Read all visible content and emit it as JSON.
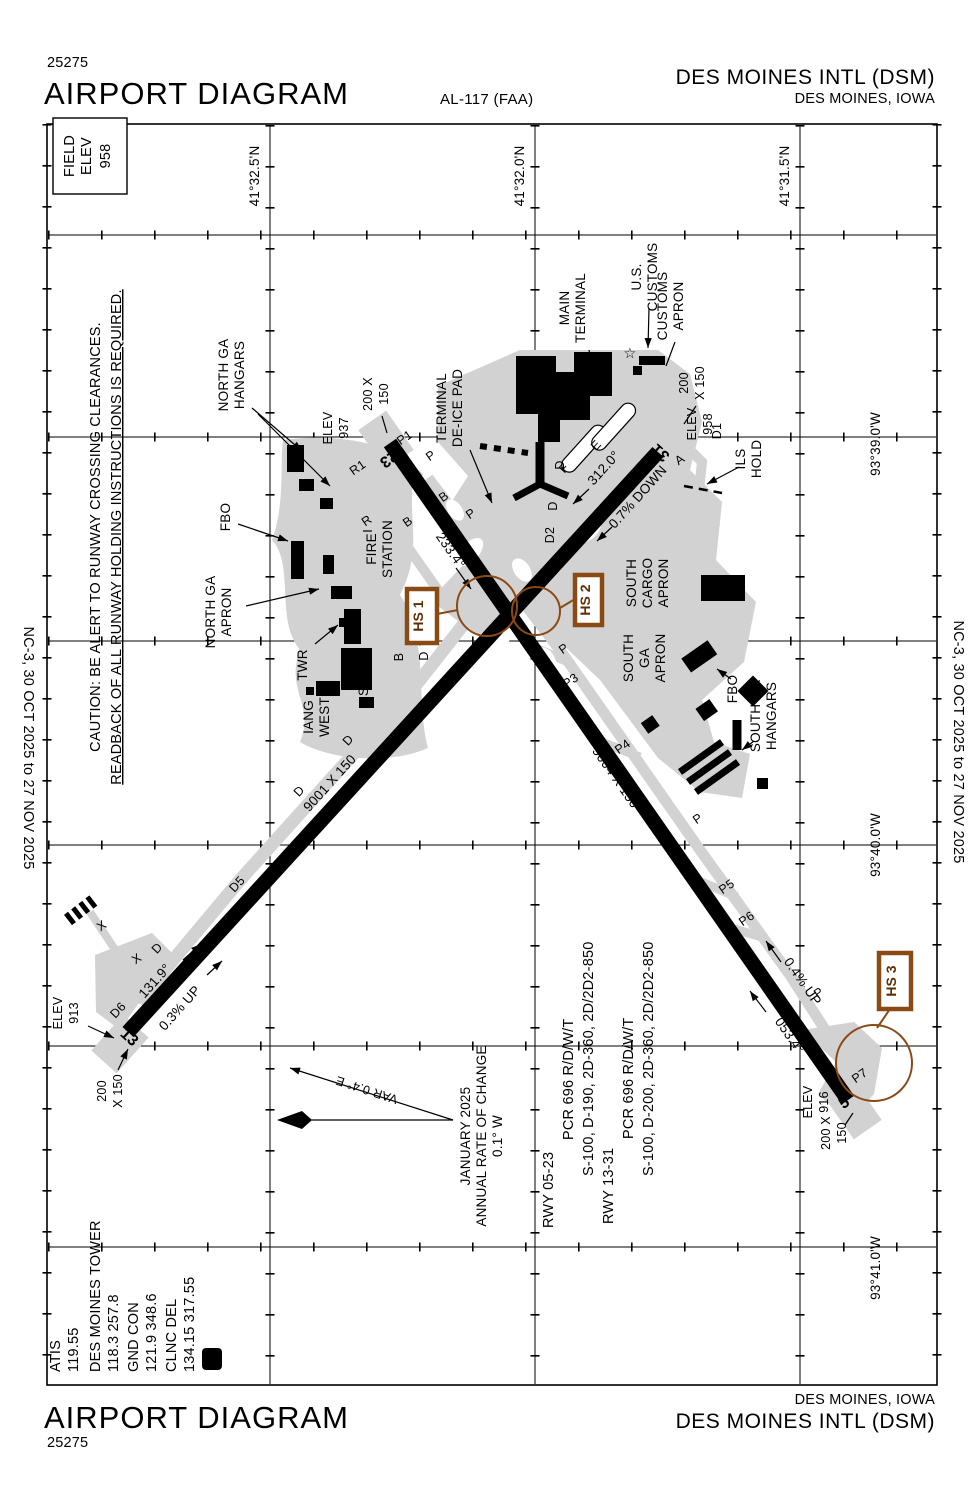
{
  "header": {
    "chart_number": "25275",
    "title": "AIRPORT DIAGRAM",
    "procedure_id": "AL-117 (FAA)",
    "airport_name": "DES MOINES INTL (DSM)",
    "city": "DES MOINES, IOWA"
  },
  "footer": {
    "title": "AIRPORT DIAGRAM",
    "chart_number": "25275",
    "city": "DES MOINES, IOWA",
    "airport_name": "DES MOINES INTL (DSM)"
  },
  "margins": {
    "left": "NC-3,  30 OCT 2025  to  27 NOV 2025",
    "right": "NC-3,  30 OCT 2025  to  27 NOV 2025"
  },
  "field_elev": [
    "FIELD",
    "ELEV",
    "958"
  ],
  "caution": {
    "line1": "CAUTION: BE ALERT TO RUNWAY CROSSING CLEARANCES.",
    "line2": "READBACK OF ALL RUNWAY HOLDING INSTRUCTIONS IS REQUIRED."
  },
  "coords": {
    "lat": [
      "41°32.5'N",
      "41°32.0'N",
      "41°31.5'N"
    ],
    "lon": [
      "93°39.0'W",
      "93°40.0'W",
      "93°41.0'W"
    ]
  },
  "comms": {
    "atis_label": "ATIS",
    "atis_freq": "119.55",
    "twr_label": "DES MOINES TOWER",
    "twr_freq": "118.3  257.8",
    "gnd_label": "GND CON",
    "gnd_freq": "121.9  348.6",
    "del_label": "CLNC DEL",
    "del_freq": "134.15  317.55",
    "cpdlc": "D"
  },
  "variation": {
    "var_label": "VAR 0.4° E",
    "rate": [
      "JANUARY 2025",
      "ANNUAL RATE OF CHANGE",
      "0.1° W"
    ]
  },
  "rwy_data": {
    "lines": [
      "RWY 05-23",
      "PCR 696 R/D/W/T",
      "S-100, D-190, 2D-360, 2D/2D2-850",
      "RWY 13-31",
      "PCR 696 R/D/W/T",
      "S-100, D-200, 2D-360, 2D/2D2-850"
    ]
  },
  "map": {
    "areas": {
      "north_ga_hangars": [
        "NORTH GA",
        "HANGARS"
      ],
      "fbo_north": "FBO",
      "north_ga_apron": [
        "NORTH GA",
        "APRON"
      ],
      "twr": "TWR",
      "iang_west": [
        "IANG",
        "WEST"
      ],
      "iang_south": [
        "IANG",
        "SOUTH"
      ],
      "fire_station": [
        "FIRE",
        "STATION"
      ],
      "terminal_deice": [
        "TERMINAL",
        "DE-ICE PAD"
      ],
      "main_terminal": [
        "MAIN",
        "TERMINAL"
      ],
      "us_customs": [
        "U.S.",
        "CUSTOMS"
      ],
      "customs_apron": [
        "CUSTOMS",
        "APRON"
      ],
      "ils_hold": [
        "ILS",
        "HOLD"
      ],
      "south_cargo_apron": [
        "SOUTH",
        "CARGO",
        "APRON"
      ],
      "south_ga_apron": [
        "SOUTH",
        "GA",
        "APRON"
      ],
      "fbo_south": "FBO",
      "south_ga_hangars": [
        "SOUTH GA",
        "HANGARS"
      ],
      "customs_star": "☆"
    },
    "elev": {
      "e937": [
        "ELEV",
        "937"
      ],
      "e958": [
        "ELEV",
        "958"
      ],
      "e913": [
        "ELEV",
        "913"
      ],
      "e916": [
        "ELEV",
        "916"
      ]
    },
    "dims": {
      "d23": [
        "200 X",
        "150"
      ],
      "d31": [
        "200",
        "X 150"
      ],
      "d13": [
        "200",
        "X 150"
      ],
      "d5": [
        "200 X",
        "150"
      ]
    },
    "rwy": {
      "r23": "23",
      "r31": "31",
      "r13": "13",
      "r5": "5",
      "len0523": "9004 X 150",
      "len1331": "9001 X 150",
      "hdg23": "233.4°",
      "hdg5": "053.4°",
      "hdg13": "131.9°",
      "hdg31": "312.0°",
      "g31": "0.7% DOWN",
      "g13": "0.3% UP",
      "g5": "0.4% UP"
    },
    "twy": [
      "P1",
      "R1",
      "R",
      "P",
      "B",
      "B",
      "P",
      "B",
      "D",
      "P",
      "P3",
      "P4",
      "P",
      "P5",
      "P6",
      "P",
      "P7",
      "D",
      "D",
      "D5",
      "D",
      "D6",
      "D",
      "D2",
      "D",
      "D1",
      "E",
      "F",
      "A",
      "X",
      "X"
    ],
    "hotspots": [
      "HS 1",
      "HS 2",
      "HS 3"
    ]
  },
  "colors": {
    "hotspot_brown": "#8a4a15",
    "pavement_gray": "#d2d2d2",
    "building_black": "#000000"
  }
}
